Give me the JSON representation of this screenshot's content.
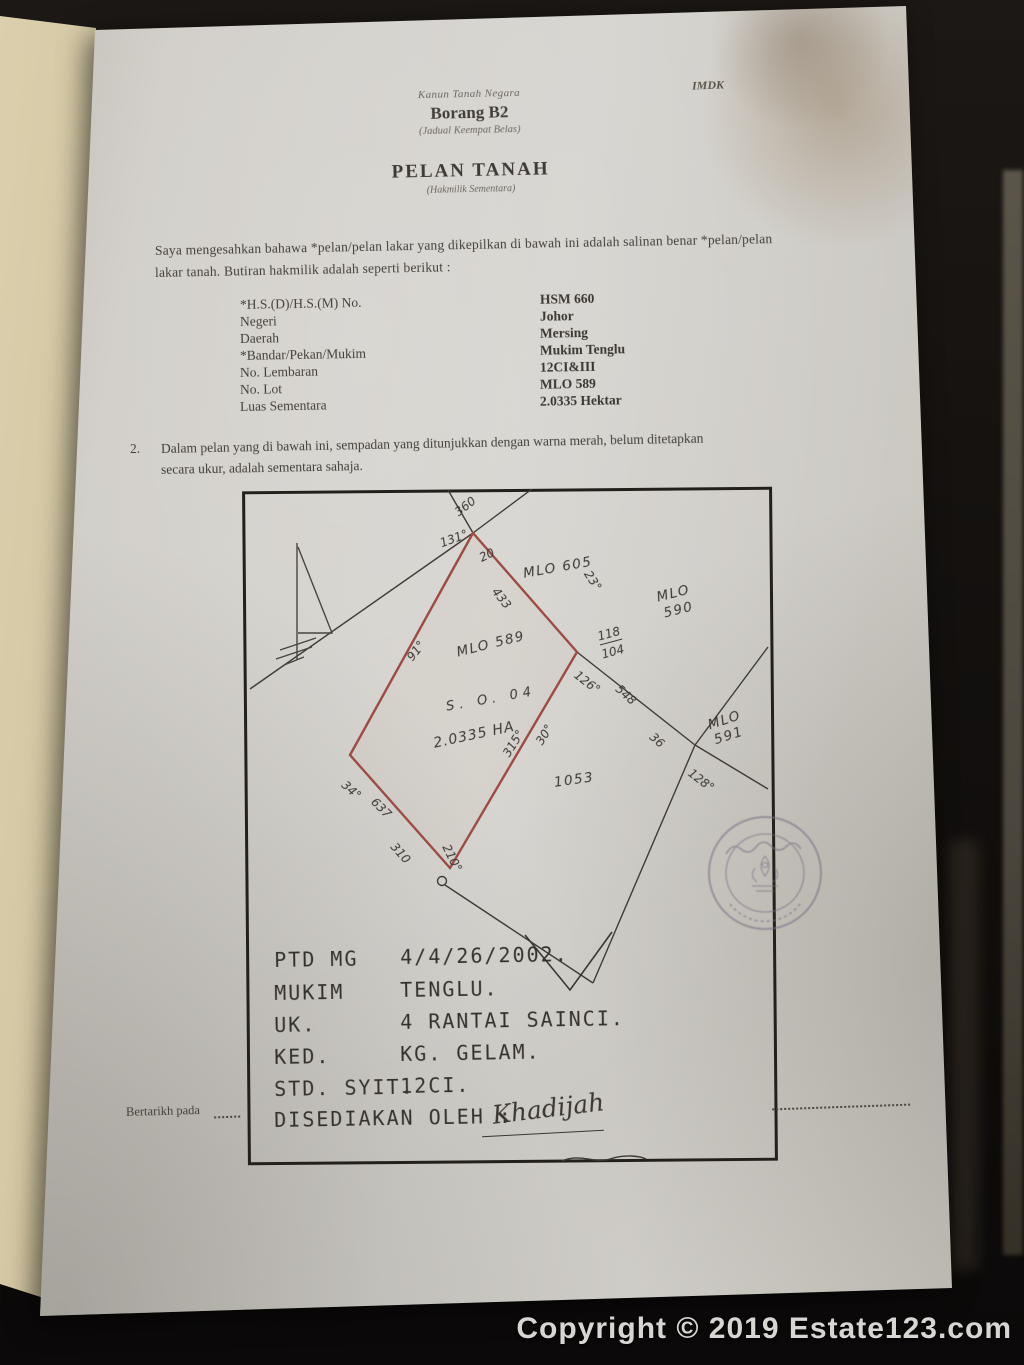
{
  "document": {
    "corner_code": "IMDK",
    "kicker": "Kanun Tanah Negara",
    "form_no": "Borang B2",
    "form_sub": "(Jadual Keempat Belas)",
    "title": "PELAN TANAH",
    "title_sub": "(Hakmilik Sementara)",
    "intro_line1": "Saya mengesahkan bahawa *pelan/pelan lakar yang dikepilkan di bawah ini adalah salinan benar *pelan/pelan",
    "intro_line2": "lakar tanah. Butiran hakmilik adalah seperti berikut :",
    "clause2_no": "2.",
    "clause2_line1": "Dalam pelan yang di bawah ini, sempadan yang ditunjukkan dengan warna merah, belum ditetapkan",
    "clause2_line2": "secara ukur, adalah sementara sahaja.",
    "bertarikh_label": "Bertarikh pada"
  },
  "fields": [
    {
      "label": "*H.S.(D)/H.S.(M) No.",
      "value": "HSM 660"
    },
    {
      "label": "Negeri",
      "value": "Johor"
    },
    {
      "label": "Daerah",
      "value": "Mersing"
    },
    {
      "label": "*Bandar/Pekan/Mukim",
      "value": "Mukim Tenglu"
    },
    {
      "label": "No. Lembaran",
      "value": "12CI&III"
    },
    {
      "label": "No. Lot",
      "value": "MLO 589"
    },
    {
      "label": "Luas Sementara",
      "value": "2.0335 Hektar"
    }
  ],
  "plan": {
    "parcels": {
      "mlo605": "MLO 605",
      "mlo590_l1": "MLO",
      "mlo590_l2": "590",
      "mlo589": "MLO 589",
      "mlo591_l1": "MLO",
      "mlo591_l2": "591",
      "lot1053": "1053",
      "survey_ref": "S. O. 04",
      "area": "2.0335 HA"
    },
    "measurements": {
      "m360": "360",
      "m131": "131°",
      "m20": "20",
      "m433": "433",
      "m23": "23°",
      "m118": "118",
      "m104": "104",
      "m126": "126°",
      "m548": "548",
      "m36": "36",
      "m128": "128°",
      "m315": "315°",
      "m30": "30°",
      "m91": "91°",
      "m34": "34°",
      "m637": "637",
      "m310": "310",
      "m210": "210°"
    }
  },
  "details": {
    "rows": [
      {
        "label": "PTD MG",
        "value": "4/4/26/2002."
      },
      {
        "label": "MUKIM",
        "value": "TENGLU."
      },
      {
        "label": "UK.",
        "value": "4 RANTAI SAINCI."
      },
      {
        "label": "KED.",
        "value": "KG. GELAM."
      },
      {
        "label": "STD. SYIT.",
        "value": "12CI."
      }
    ],
    "prepared_by_label": "DISEDIAKAN OLEH :",
    "signature": "Khadijah"
  },
  "watermark": "Copyright © 2019 Estate123.com",
  "colors": {
    "boundary_red": "#9d4b43",
    "ink": "#3b3733",
    "stamp": "#7d7386"
  }
}
